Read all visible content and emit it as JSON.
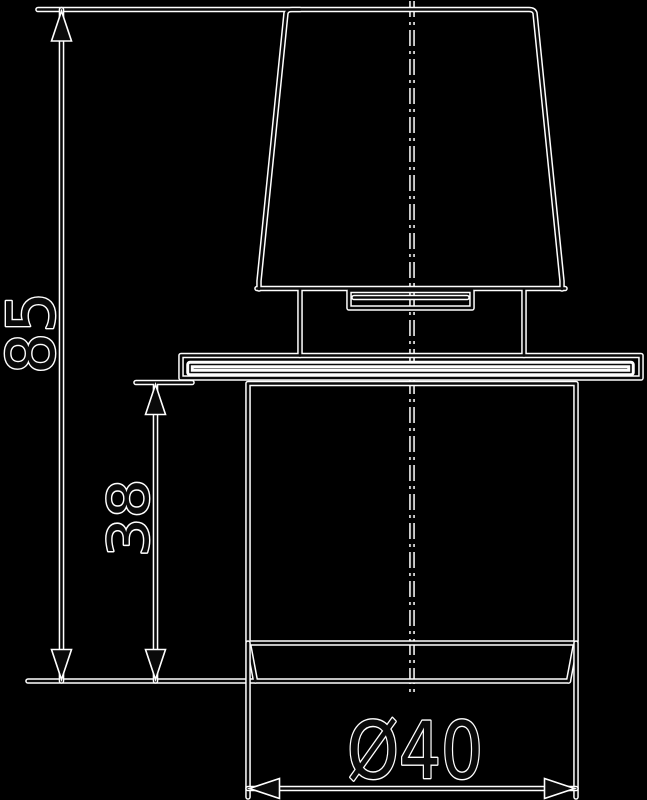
{
  "drawing": {
    "type": "technical-dimension-drawing",
    "subject": "knob with flange and cylindrical body, side elevation",
    "background_color": "#000000",
    "ink_color": "#0a0a0a",
    "halo_color": "#ffffff",
    "centerline": {
      "style": "dash-dot",
      "orientation": "vertical"
    },
    "parts": [
      "tapered-cap",
      "stem",
      "slot-plate",
      "flange",
      "cylindrical-body"
    ],
    "dimensions": [
      {
        "name": "overall-height",
        "label": "85",
        "orientation": "vertical"
      },
      {
        "name": "body-depth-below-flange",
        "label": "38",
        "orientation": "vertical"
      },
      {
        "name": "body-diameter",
        "label": "Ø40",
        "orientation": "horizontal"
      }
    ]
  }
}
